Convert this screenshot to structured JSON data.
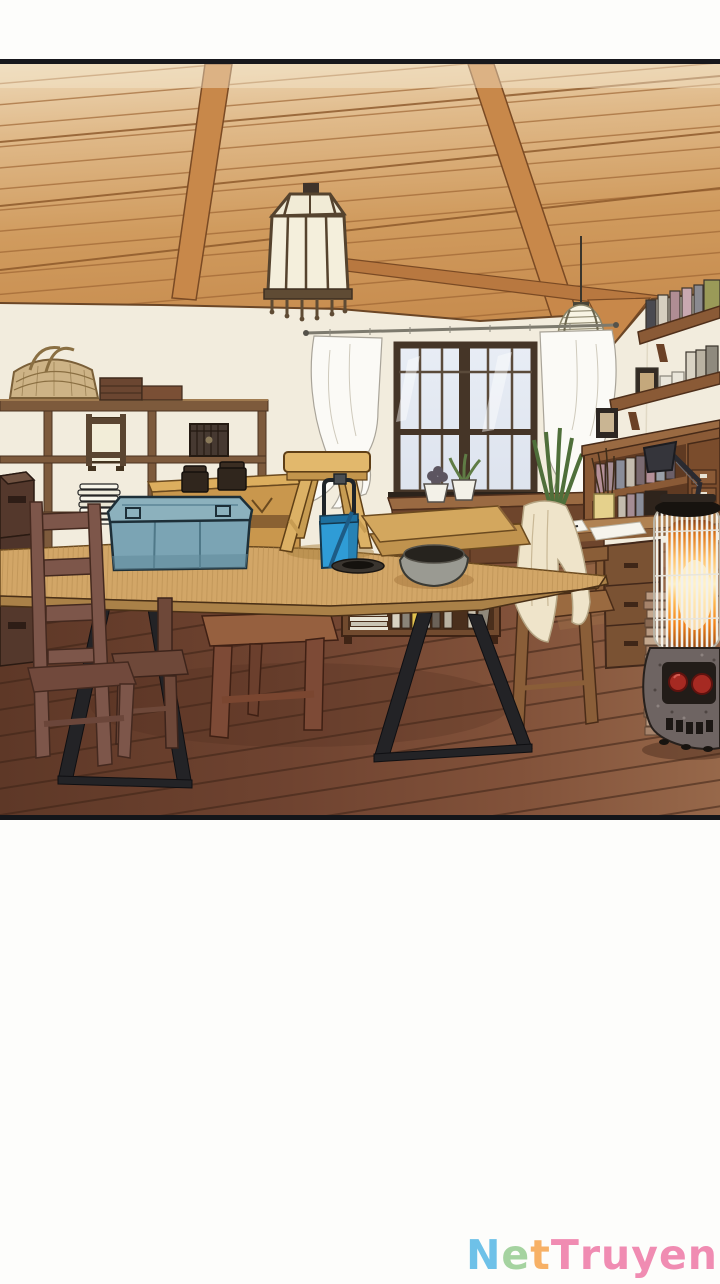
{
  "panel": {
    "type": "comic-illustration",
    "alt": "Sunlit craft workroom: wooden plank ceiling with beams, hexagonal pendant lantern, small paper lantern, window with sheer white curtains, open shelving with basket and lamp, large work table holding a blue storage box, wooden stool, blue bucket, planks and a bowl, wooden chairs, writing desk with articulated lamp and bookshelves, wall book shelves, and a glowing kerosene heater on a dark plank floor",
    "border_color": "#17181c",
    "background_white": "#fdfdfb",
    "wall_color": "#f2ecdd",
    "ceiling_wood": "#cf9a5e",
    "floor_wood": "#6f4330",
    "table_wood": "#d2a667",
    "storage_box_blue": "#7ba4b4",
    "bucket_blue": "#2f9cd6",
    "heater_glow": "#ff9a2e",
    "heater_knob_red": "#a62a22",
    "curtain_white": "#fbfaf6",
    "objects": [
      "wood-ceiling",
      "ceiling-beams",
      "pendant-lantern",
      "paper-lantern",
      "window",
      "sheer-curtains",
      "curtain-rod",
      "open-shelf-unit",
      "wicker-basket",
      "shelf-lamp",
      "wooden-chest",
      "stacked-plates",
      "wooden-crates",
      "yellow-bench",
      "ladder-back-chair",
      "side-chair",
      "work-table",
      "blue-storage-box",
      "wooden-stool",
      "blue-bucket",
      "wood-planks",
      "gray-bowl",
      "black-dish",
      "under-table-bookshelf",
      "window-sideboard",
      "potted-plants",
      "desk-hutch",
      "desk-lamp",
      "pencil-cup",
      "photo-frame",
      "desk-drawers",
      "desk-chair",
      "draped-cloth",
      "wall-shelves",
      "books",
      "kerosene-heater",
      "book-stack",
      "plank-floor"
    ]
  },
  "watermark": {
    "text": "NetTruyen",
    "letters": [
      {
        "char": "N",
        "color": "#6ec1e8"
      },
      {
        "char": "e",
        "color": "#a5d3a0"
      },
      {
        "char": "t",
        "color": "#f7b166"
      },
      {
        "char": "T",
        "color": "#f08cb2"
      },
      {
        "char": "r",
        "color": "#f08cb2"
      },
      {
        "char": "u",
        "color": "#f08cb2"
      },
      {
        "char": "y",
        "color": "#f08cb2"
      },
      {
        "char": "e",
        "color": "#f08cb2"
      },
      {
        "char": "n",
        "color": "#f08cb2"
      }
    ]
  }
}
